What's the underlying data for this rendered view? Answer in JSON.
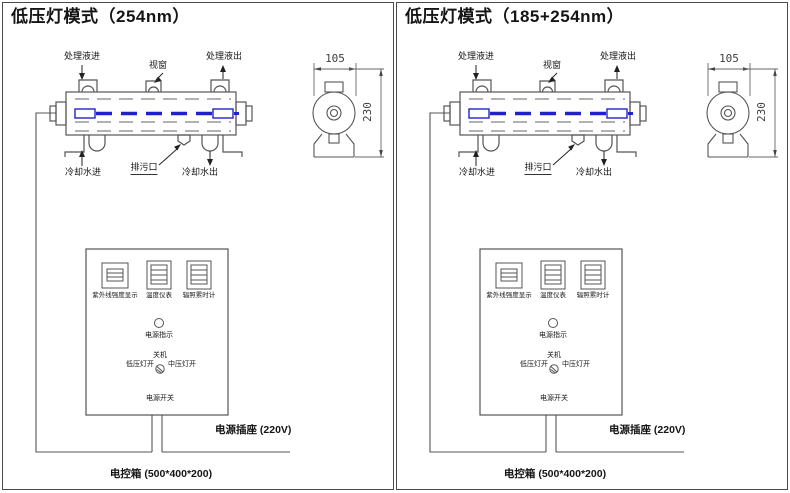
{
  "colors": {
    "line_gray": "#555555",
    "dash_gray": "#999999",
    "lamp_blue": "#2121cc",
    "text": "#151515"
  },
  "panels": [
    {
      "title": "低压灯模式（254nm）",
      "chamber": {
        "inlet_label": "处理液进",
        "window_label": "视窗",
        "outlet_label": "处理液出",
        "cooling_in_label": "冷却水进",
        "drain_label": "排污口",
        "cooling_out_label": "冷却水出"
      },
      "end_view": {
        "width_dim": "105",
        "height_dim": "230"
      },
      "control_box": {
        "meters": [
          {
            "label": "紫外线强度显示"
          },
          {
            "label": "温度仪表"
          },
          {
            "label": "辐照累时计"
          }
        ],
        "power_indicator_label": "电源指示",
        "switch": {
          "off_label": "关机",
          "low_label": "低压灯开",
          "medium_label": "中压灯开",
          "name_label": "电源开关"
        }
      },
      "socket_label": "电源插座 (220V)",
      "box_label": "电控箱 (500*400*200)"
    },
    {
      "title": "低压灯模式（185+254nm）",
      "chamber": {
        "inlet_label": "处理液进",
        "window_label": "视窗",
        "outlet_label": "处理液出",
        "cooling_in_label": "冷却水进",
        "drain_label": "排污口",
        "cooling_out_label": "冷却水出"
      },
      "end_view": {
        "width_dim": "105",
        "height_dim": "230"
      },
      "control_box": {
        "meters": [
          {
            "label": "紫外线强度显示"
          },
          {
            "label": "温度仪表"
          },
          {
            "label": "辐照累时计"
          }
        ],
        "power_indicator_label": "电源指示",
        "switch": {
          "off_label": "关机",
          "low_label": "低压灯开",
          "medium_label": "中压灯开",
          "name_label": "电源开关"
        }
      },
      "socket_label": "电源插座 (220V)",
      "box_label": "电控箱 (500*400*200)"
    }
  ]
}
